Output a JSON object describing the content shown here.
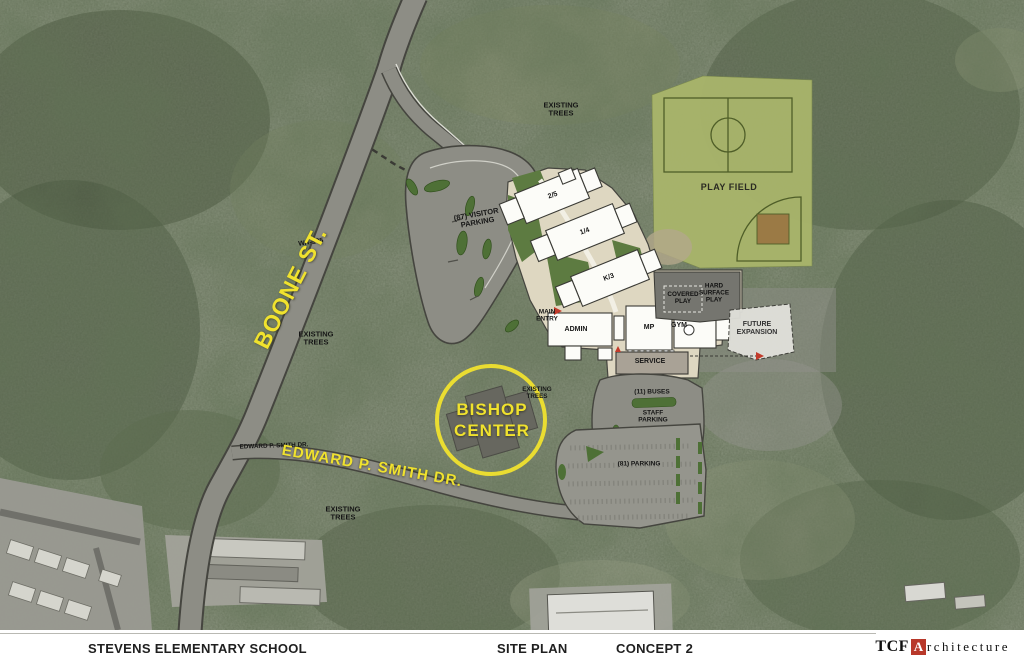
{
  "footer": {
    "project": "STEVENS ELEMENTARY SCHOOL",
    "sheet": "SITE PLAN",
    "concept": "CONCEPT 2",
    "firm": {
      "tcf": "TCF",
      "a": "A",
      "rest": "rchitecture"
    }
  },
  "labels": {
    "existing_trees_top": "EXISTING TREES",
    "play_field": "PLAY FIELD",
    "wa_105": "WA-105",
    "boone_st": "BOONE ST.",
    "visitor_parking": "(87) VISITOR PARKING",
    "existing_trees_left": "EXISTING TREES",
    "wing_25": "2/5",
    "wing_14": "1/4",
    "wing_k3": "K/3",
    "main_entry": "MAIN ENTRY",
    "admin": "ADMIN",
    "mp": "MP",
    "gym": "GYM",
    "covered_play": "COVERED PLAY",
    "hard_surface_play": "HARD SURFACE PLAY",
    "future_expansion": "FUTURE EXPANSION",
    "service": "SERVICE",
    "buses": "(11) BUSES",
    "staff_parking": "STAFF PARKING",
    "parking": "(81) PARKING",
    "bishop_center": "BISHOP CENTER",
    "existing_trees_circle": "EXISTING TREES",
    "edward_smith_small": "EDWARD P. SMITH DR.",
    "edward_smith_large": "EDWARD P. SMITH DR.",
    "existing_trees_bottom": "EXISTING TREES"
  },
  "colors": {
    "highlight_yellow": "#f0e22e",
    "logo_red": "#b8382a",
    "plan_tan": "#ded7c1",
    "playfield_green": "#a9b56b",
    "island_green": "#4e7036",
    "road_gray": "#8d8d85"
  }
}
